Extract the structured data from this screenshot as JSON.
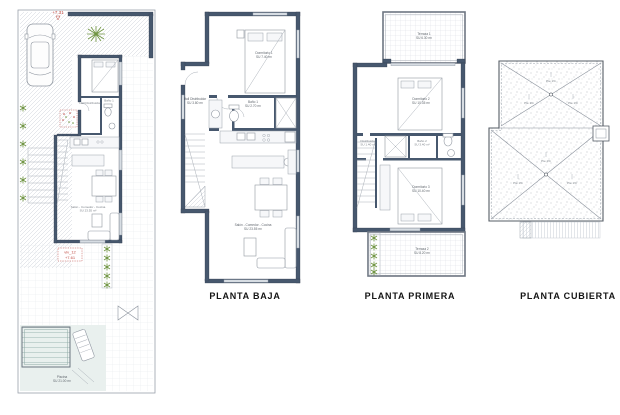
{
  "captions": {
    "baja": "PLANTA BAJA",
    "primera": "PLANTA PRIMERA",
    "cubierta": "PLANTA CUBIERTA"
  },
  "colors": {
    "wall": "#47586e",
    "annotation_red": "#bf4a42",
    "plant_green": "#6f9440",
    "pool_tint": "#e9f0ee"
  },
  "site_plan": {
    "elevation_marker": "+7.31",
    "unit_box": {
      "line1": "viv_12",
      "line2": "+7.61"
    },
    "pool": {
      "name": "Piscina",
      "area": "SU 21.00 m²"
    }
  },
  "planta_baja": {
    "rooms": {
      "dormitorio1": {
        "name": "Dormitorio 1",
        "area": "SU 7.40 m²"
      },
      "hall": {
        "name": "Hall Distribuidor",
        "area": "SU 3.80 m²"
      },
      "bano1": {
        "name": "Baño 1",
        "area": "SU 2.70 m²"
      },
      "salon": {
        "name": "Salón - Comedor - Cocina",
        "area": "SU 23.55 m²"
      }
    }
  },
  "planta_primera": {
    "rooms": {
      "terraza1": {
        "name": "Terraza 1",
        "area": "SU 6.30 m²"
      },
      "dormitorio2": {
        "name": "Dormitorio 2",
        "area": "SU 10.35 m²"
      },
      "distribuidor": {
        "name": "Distribuidor",
        "area": "SU 1.40 m²"
      },
      "bano2": {
        "name": "Baño 2",
        "area": "SU 3.40 m²"
      },
      "dormitorio3": {
        "name": "Dormitorio 3",
        "area": "SU 10.40 m²"
      },
      "terraza2": {
        "name": "Terraza 2",
        "area": "SU 8.20 m²"
      }
    }
  },
  "planta_cubierta": {
    "slope_labels": [
      "Pte 1%",
      "Pte 1%",
      "Pte 1%",
      "Pte 1%",
      "Pte 1%",
      "Pte 1%"
    ]
  }
}
